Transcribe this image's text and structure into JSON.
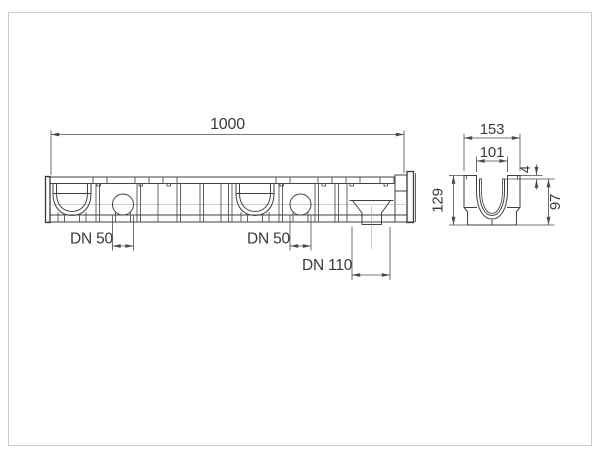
{
  "drawing": {
    "labels": {
      "length": "1000",
      "dn50_left": "DN 50",
      "dn50_right": "DN 50",
      "dn110": "DN 110",
      "section_outer_width": "153",
      "section_inner_width": "101",
      "section_edge_gap": "4",
      "section_height": "129",
      "section_inner_depth": "97"
    },
    "colors": {
      "line": "#414141",
      "dimension": "#4a4a4a",
      "centerline": "#9f9f9f",
      "frame": "#cbcbcb",
      "background": "#ffffff"
    }
  }
}
